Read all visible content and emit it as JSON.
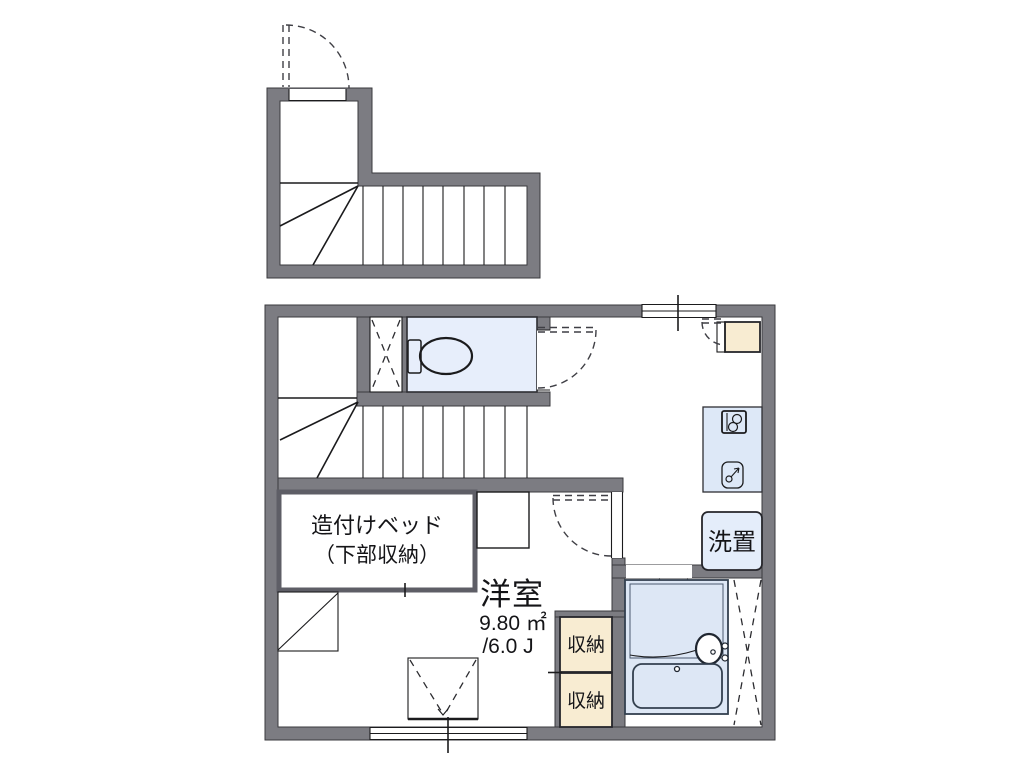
{
  "plan": {
    "title": "apartment-floor-plan",
    "labels": {
      "bed_line1": "造付けベッド",
      "bed_line2": "（下部収納）",
      "room_name": "洋室",
      "room_area_m2": "9.80 ㎡",
      "room_area_jo": "/6.0 J",
      "storage_top": "収納",
      "storage_bottom": "収納",
      "laundry": "洗置"
    },
    "colors": {
      "wall": "#7c7c82",
      "wall_edge": "#3a3a3e",
      "line": "#1b1b1d",
      "toilet_room": "#e7eefb",
      "bath": "#dde7f5",
      "kitchen": "#dde8f7",
      "laundry": "#e4edfa",
      "storage": "#f8ecd2",
      "floor": "#ffffff"
    }
  }
}
